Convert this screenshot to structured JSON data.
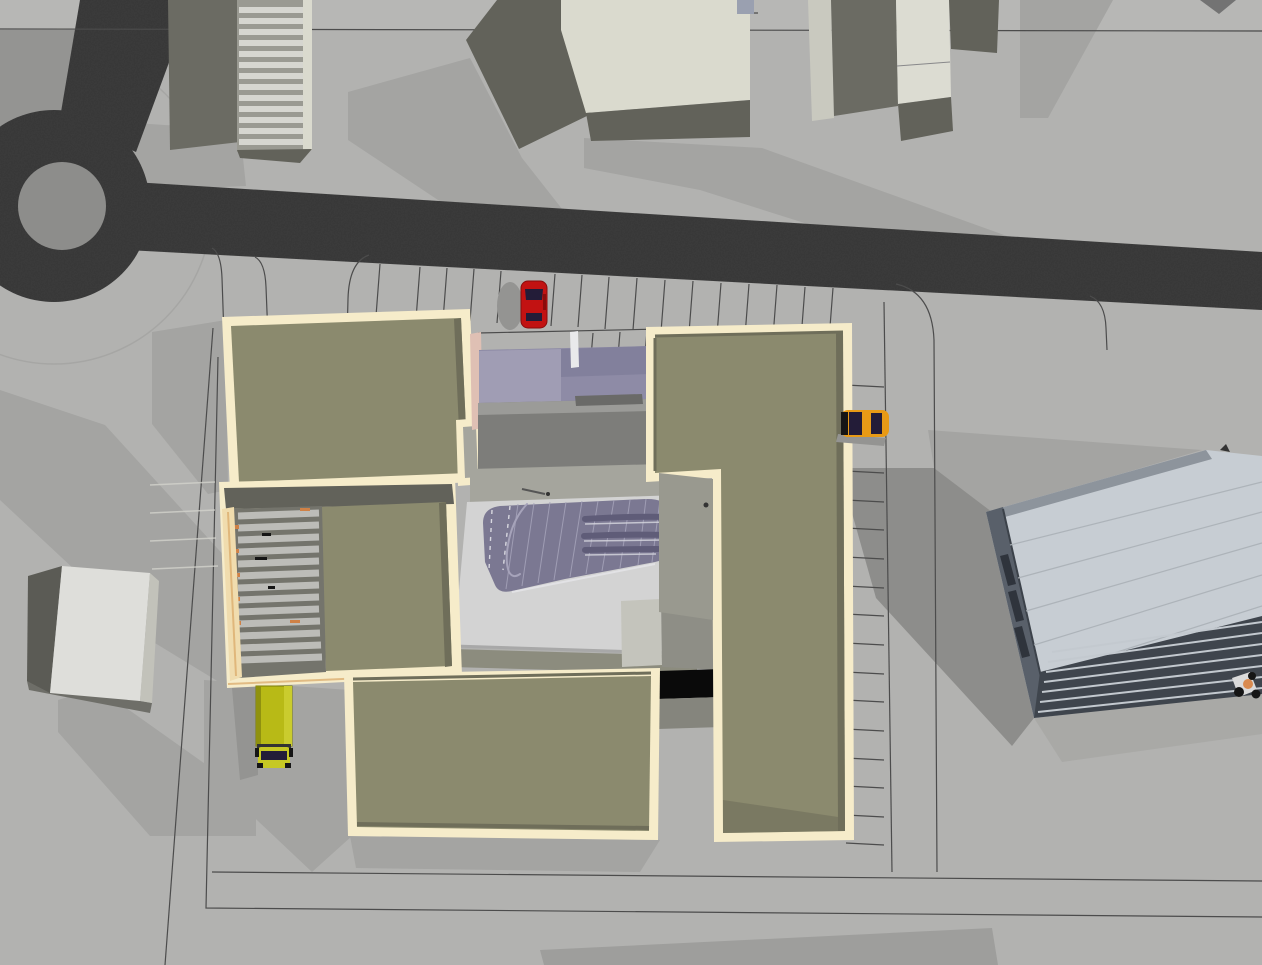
{
  "scene": {
    "type": "3d-aerial-site-model",
    "objects": [
      "roundabout",
      "north-access-road",
      "main-road",
      "outer-apron-circle",
      "north-parking-row",
      "east-parking-row",
      "west-parking-stalls",
      "context-building-striped",
      "context-building-center",
      "context-building-east",
      "white-box-building",
      "main-building-northwest-block",
      "louvered-roof-wing",
      "south-block",
      "east-l-shaped-wing",
      "entrance-canopy",
      "freeform-glass-atrium-roof",
      "loading-dock",
      "service-yard",
      "glass-office-slab",
      "red-car",
      "orange-car",
      "yellow-box-truck",
      "pedestrian-figure"
    ],
    "vehicles": {
      "count": 3,
      "red_car": "parked facing north",
      "orange_car": "parked facing west",
      "yellow_truck": "parked facing south"
    }
  },
  "colors": {
    "ground": "#b2b2b0",
    "groundTop": "#b7b7b5",
    "shadowLight": "#a4a4a2",
    "shadowMid": "#949492",
    "shadowDark": "#8d8d8b",
    "road": "#3d3d3d",
    "roadIsland": "#8d8d8b",
    "apronLine": "#a6a6a4",
    "lineDark": "#4c4c4c",
    "lineLight": "#d2d2cc",
    "cream": "#f6ecca",
    "creamEdge": "#f0dcae",
    "orangeGlow": "#d9a765",
    "khaki": "#8b8a6e",
    "khakiDark": "#6f6e5a",
    "khakiStrip": "#8c8c7e",
    "canopy": "#8e8ba6",
    "canopyLight": "#a3a0b6",
    "canopyDark": "#82809c",
    "canopyPink": "#dfc0b4",
    "darkGlass": "#565b66",
    "pillarWhite": "#e9e9eb",
    "grayRoof": "#7d7d7a",
    "grayRoofLight": "#9b9b98",
    "grayDark": "#6a6a68",
    "walkway": "#a5a59d",
    "whiteRoof": "#d3d3d3",
    "whiteRoofEdge": "#a8a8a8",
    "blob": "#7b7892",
    "blobLine": "#a6a3ba",
    "blobVent": "#5f5c78",
    "blobDash": "#d8d8e0",
    "blobHighlight": "#e8e8ec",
    "dock": "#0a0a0a",
    "pad": "#99998f",
    "connector": "#8e8e86",
    "connectorLight": "#c4c4bc",
    "connectorDark": "#85857d",
    "slatBase": "#74746c",
    "slatLight": "#bcbcb8",
    "accentOrange": "#cf8146",
    "topGray": "#6b6b63",
    "topDark": "#62625a",
    "topCream": "#dadace",
    "topCream2": "#dcdcd2",
    "topCreamDim": "#c9c9bf",
    "stripeBg": "#9a9a92",
    "stripe": "#d6d6d0",
    "blueBox": "#9aa0b0",
    "triGray": "#737373",
    "lineMid": "#88888a",
    "boxTop": "#dededa",
    "boxWest": "#5b5b55",
    "boxEast": "#c2c2ba",
    "boxBase": "#6e6e68",
    "glassPanel": "#c7cdd3",
    "glassEdge": "#59606a",
    "glassFrame": "#8d949c",
    "glassSeam": "#aab0b6",
    "glassDarkLine": "#3c424a",
    "louverDark": "#3f454d",
    "louverLight": "#c3c9cf",
    "slot": "#2f343c",
    "carRed": "#c21212",
    "carRedDark": "#8a0c0c",
    "carOrange": "#e89a16",
    "windshield": "#231c38",
    "truckBox": "#b8ba16",
    "truckBoxLight": "#cacc2e",
    "truckBoxDark": "#8f910f",
    "truckCab": "#c6c824",
    "truckOutline": "#7a7c0a",
    "blackish": "#151515",
    "scratch": "#555555",
    "dotDark": "#333333",
    "figureOrange": "#d98a4f",
    "figureWhite": "#dadada",
    "bottomSliver": "#9e9e9c"
  }
}
